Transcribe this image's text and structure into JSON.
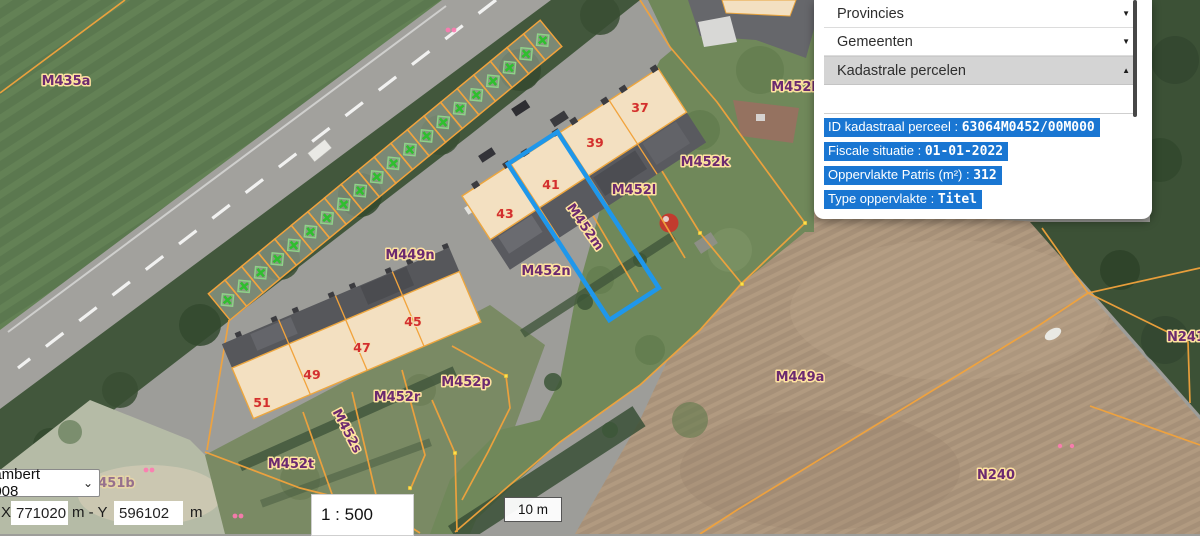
{
  "map": {
    "labels": [
      {
        "text": "M435a"
      },
      {
        "text": "M452b"
      },
      {
        "text": "M452k"
      },
      {
        "text": "M452l"
      },
      {
        "text": "M452m"
      },
      {
        "text": "M452n"
      },
      {
        "text": "M449n"
      },
      {
        "text": "M452p"
      },
      {
        "text": "M452r"
      },
      {
        "text": "M452s"
      },
      {
        "text": "M452t"
      },
      {
        "text": "M451b"
      },
      {
        "text": "M449a"
      },
      {
        "text": "N240"
      },
      {
        "text": "N241"
      }
    ],
    "house_numbers": [
      "37",
      "39",
      "41",
      "43",
      "45",
      "47",
      "49",
      "51"
    ],
    "style": {
      "parcel_line_color": "#f2a33c",
      "selected_parcel_color": "#1f97ea",
      "parcel_label_color": "#6b2a70",
      "house_number_color": "#d32f2f",
      "building_fill": "#f3e0c1",
      "garage_cross_color": "#2fbf2f"
    }
  },
  "panel": {
    "sections": [
      {
        "label": "Provincies",
        "chevron": "▼",
        "state": "collapsed"
      },
      {
        "label": "Gemeenten",
        "chevron": "▼",
        "state": "collapsed"
      },
      {
        "label": "Kadastrale percelen",
        "chevron": "▲",
        "state": "expanded"
      }
    ],
    "info": [
      {
        "label": "ID kadastraal perceel :",
        "value": "63064M0452/00M000"
      },
      {
        "label": "Fiscale situatie :",
        "value": "01-01-2022"
      },
      {
        "label": "Oppervlakte Patris (m²) :",
        "value": "312"
      },
      {
        "label": "Type oppervlakte :",
        "value": "Titel"
      }
    ],
    "highlight_color": "#1976d2"
  },
  "controls": {
    "projection_select": {
      "value": "Lambert 2008",
      "chevron": "⌄"
    },
    "coords": {
      "x_label": "X",
      "x_value": "771020",
      "separator": "m - Y",
      "y_value": "596102",
      "unit": "m"
    },
    "scale_input": {
      "value": "1 : 500"
    },
    "scale_bar": {
      "label": "10 m"
    }
  }
}
